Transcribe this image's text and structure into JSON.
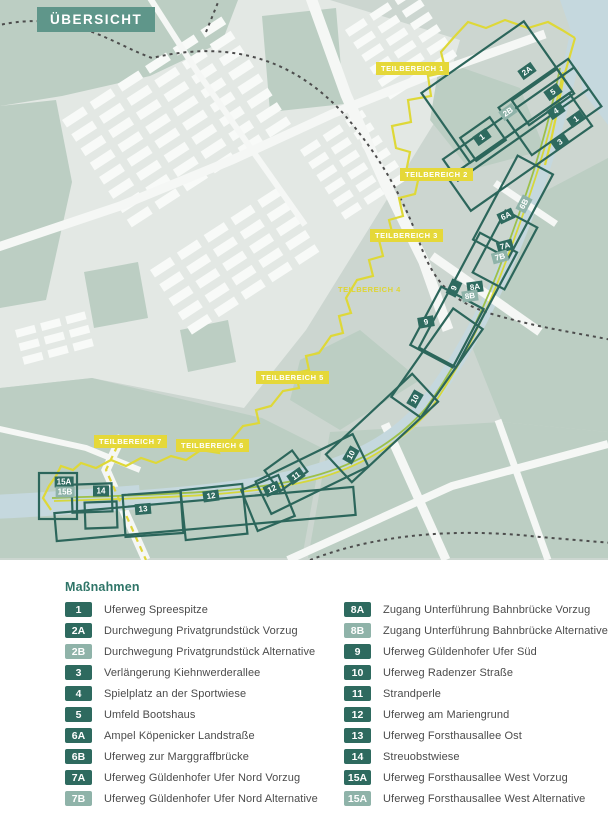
{
  "header": {
    "title": "ÜBERSICHT"
  },
  "map": {
    "colors": {
      "banner_teal": "#5f968a",
      "area_outline_teal": "#2c665b",
      "badge_dark_teal": "#2e6a5f",
      "badge_light_teal": "#8fb3a9",
      "boundary_yellow": "#ded838",
      "label_yellow": "#e5d839",
      "river_blue": "#c5d8de",
      "park_sage": "#bccec3",
      "route_green": "#9dc04a"
    },
    "teilbereich_labels": [
      {
        "text": "TEILBEREICH 1",
        "x": 376,
        "y": 62,
        "boxed": true
      },
      {
        "text": "TEILBEREICH 2",
        "x": 400,
        "y": 168,
        "boxed": true
      },
      {
        "text": "TEILBEREICH 3",
        "x": 370,
        "y": 229,
        "boxed": true
      },
      {
        "text": "TEILBEREICH 4",
        "x": 338,
        "y": 285,
        "boxed": false
      },
      {
        "text": "TEILBEREICH 5",
        "x": 256,
        "y": 371,
        "boxed": true
      },
      {
        "text": "TEILBEREICH 6",
        "x": 176,
        "y": 439,
        "boxed": true
      },
      {
        "text": "TEILBEREICH 7",
        "x": 94,
        "y": 435,
        "boxed": true
      }
    ],
    "badges": [
      {
        "code": "2A",
        "x": 527,
        "y": 71,
        "rot": -35,
        "variant": "dark"
      },
      {
        "code": "5",
        "x": 553,
        "y": 92,
        "rot": -35,
        "variant": "dark"
      },
      {
        "code": "4",
        "x": 556,
        "y": 111,
        "rot": -35,
        "variant": "dark"
      },
      {
        "code": "1",
        "x": 576,
        "y": 119,
        "rot": -35,
        "variant": "dark"
      },
      {
        "code": "2B",
        "x": 508,
        "y": 112,
        "rot": -35,
        "variant": "light"
      },
      {
        "code": "1",
        "x": 482,
        "y": 137,
        "rot": -35,
        "variant": "dark"
      },
      {
        "code": "3",
        "x": 560,
        "y": 142,
        "rot": -35,
        "variant": "dark"
      },
      {
        "code": "6B",
        "x": 524,
        "y": 204,
        "rot": -62,
        "variant": "light"
      },
      {
        "code": "6A",
        "x": 506,
        "y": 216,
        "rot": -25,
        "variant": "dark"
      },
      {
        "code": "7A",
        "x": 505,
        "y": 246,
        "rot": -15,
        "variant": "dark"
      },
      {
        "code": "7B",
        "x": 500,
        "y": 257,
        "rot": -15,
        "variant": "light"
      },
      {
        "code": "9",
        "x": 454,
        "y": 288,
        "rot": -65,
        "variant": "dark"
      },
      {
        "code": "8A",
        "x": 475,
        "y": 287,
        "rot": -8,
        "variant": "dark"
      },
      {
        "code": "8B",
        "x": 470,
        "y": 296,
        "rot": -8,
        "variant": "light"
      },
      {
        "code": "9",
        "x": 426,
        "y": 322,
        "rot": -10,
        "variant": "dark"
      },
      {
        "code": "10",
        "x": 415,
        "y": 399,
        "rot": -60,
        "variant": "dark"
      },
      {
        "code": "10",
        "x": 351,
        "y": 455,
        "rot": -60,
        "variant": "dark"
      },
      {
        "code": "11",
        "x": 296,
        "y": 476,
        "rot": -35,
        "variant": "dark"
      },
      {
        "code": "12",
        "x": 272,
        "y": 489,
        "rot": -25,
        "variant": "dark"
      },
      {
        "code": "12",
        "x": 211,
        "y": 496,
        "rot": -8,
        "variant": "dark"
      },
      {
        "code": "13",
        "x": 143,
        "y": 509,
        "rot": -5,
        "variant": "dark"
      },
      {
        "code": "14",
        "x": 101,
        "y": 491,
        "rot": 0,
        "variant": "dark"
      },
      {
        "code": "15A",
        "x": 64,
        "y": 482,
        "rot": 0,
        "variant": "dark"
      },
      {
        "code": "15B",
        "x": 65,
        "y": 492,
        "rot": 0,
        "variant": "light"
      }
    ],
    "area_rects": [
      {
        "cx": 497,
        "cy": 92,
        "w": 125,
        "h": 85,
        "rot": -35
      },
      {
        "cx": 550,
        "cy": 107,
        "w": 85,
        "h": 58,
        "rot": -35
      },
      {
        "cx": 543,
        "cy": 97,
        "w": 55,
        "h": 30,
        "rot": -35
      },
      {
        "cx": 483,
        "cy": 139,
        "w": 36,
        "h": 28,
        "rot": -35
      },
      {
        "cx": 516,
        "cy": 124,
        "w": 160,
        "h": 26,
        "rot": -35
      },
      {
        "cx": 520,
        "cy": 152,
        "w": 148,
        "h": 40,
        "rot": -35
      },
      {
        "cx": 513,
        "cy": 207,
        "w": 95,
        "h": 40,
        "rot": -62
      },
      {
        "cx": 505,
        "cy": 250,
        "w": 70,
        "h": 36,
        "rot": -62
      },
      {
        "cx": 468,
        "cy": 300,
        "w": 130,
        "h": 42,
        "rot": -62
      },
      {
        "cx": 447,
        "cy": 327,
        "w": 66,
        "h": 48,
        "rot": -62
      },
      {
        "cx": 437,
        "cy": 363,
        "w": 108,
        "h": 36,
        "rot": -55
      },
      {
        "cx": 382,
        "cy": 428,
        "w": 118,
        "h": 38,
        "rot": -43
      },
      {
        "cx": 312,
        "cy": 474,
        "w": 108,
        "h": 36,
        "rot": -26
      },
      {
        "cx": 286,
        "cy": 471,
        "w": 34,
        "h": 26,
        "rot": -36
      },
      {
        "cx": 268,
        "cy": 503,
        "w": 40,
        "h": 44,
        "rot": -22
      },
      {
        "cx": 214,
        "cy": 512,
        "w": 62,
        "h": 50,
        "rot": -6
      },
      {
        "cx": 153,
        "cy": 514,
        "w": 58,
        "h": 42,
        "rot": -4
      },
      {
        "cx": 205,
        "cy": 514,
        "w": 300,
        "h": 28,
        "rot": -5
      },
      {
        "cx": 92,
        "cy": 498,
        "w": 40,
        "h": 28,
        "rot": -2
      },
      {
        "cx": 58,
        "cy": 496,
        "w": 38,
        "h": 46,
        "rot": 0
      },
      {
        "cx": 101,
        "cy": 515,
        "w": 32,
        "h": 26,
        "rot": -2
      }
    ]
  },
  "legend": {
    "title": "Maßnahmen",
    "columns": [
      {
        "items": [
          {
            "code": "1",
            "variant": "dark",
            "label": "Uferweg Spreespitze"
          },
          {
            "code": "2A",
            "variant": "dark",
            "label": "Durchwegung Privatgrundstück Vorzug"
          },
          {
            "code": "2B",
            "variant": "light",
            "label": "Durchwegung Privatgrundstück Alternative"
          },
          {
            "code": "3",
            "variant": "dark",
            "label": "Verlängerung Kiehnwerderallee"
          },
          {
            "code": "4",
            "variant": "dark",
            "label": "Spielplatz an der Sportwiese"
          },
          {
            "code": "5",
            "variant": "dark",
            "label": "Umfeld Bootshaus"
          },
          {
            "code": "6A",
            "variant": "dark",
            "label": "Ampel Köpenicker Landstraße"
          },
          {
            "code": "6B",
            "variant": "dark",
            "label": "Uferweg zur Marggraffbrücke"
          },
          {
            "code": "7A",
            "variant": "dark",
            "label": "Uferweg Güldenhofer Ufer Nord Vorzug"
          },
          {
            "code": "7B",
            "variant": "light",
            "label": "Uferweg Güldenhofer Ufer Nord Alternative"
          }
        ]
      },
      {
        "items": [
          {
            "code": "8A",
            "variant": "dark",
            "label": "Zugang Unterführung Bahnbrücke Vorzug"
          },
          {
            "code": "8B",
            "variant": "light",
            "label": "Zugang Unterführung Bahnbrücke Alternative"
          },
          {
            "code": "9",
            "variant": "dark",
            "label": "Uferweg Güldenhofer Ufer Süd"
          },
          {
            "code": "10",
            "variant": "dark",
            "label": "Uferweg Radenzer Straße"
          },
          {
            "code": "11",
            "variant": "dark",
            "label": "Strandperle"
          },
          {
            "code": "12",
            "variant": "dark",
            "label": "Uferweg am Mariengrund"
          },
          {
            "code": "13",
            "variant": "dark",
            "label": "Uferweg Forsthausallee Ost"
          },
          {
            "code": "14",
            "variant": "dark",
            "label": "Streuobstwiese"
          },
          {
            "code": "15A",
            "variant": "dark",
            "label": "Uferweg Forsthausallee West Vorzug"
          },
          {
            "code": "15A",
            "variant": "light",
            "label": "Uferweg Forsthausallee West Alternative"
          }
        ]
      }
    ]
  }
}
